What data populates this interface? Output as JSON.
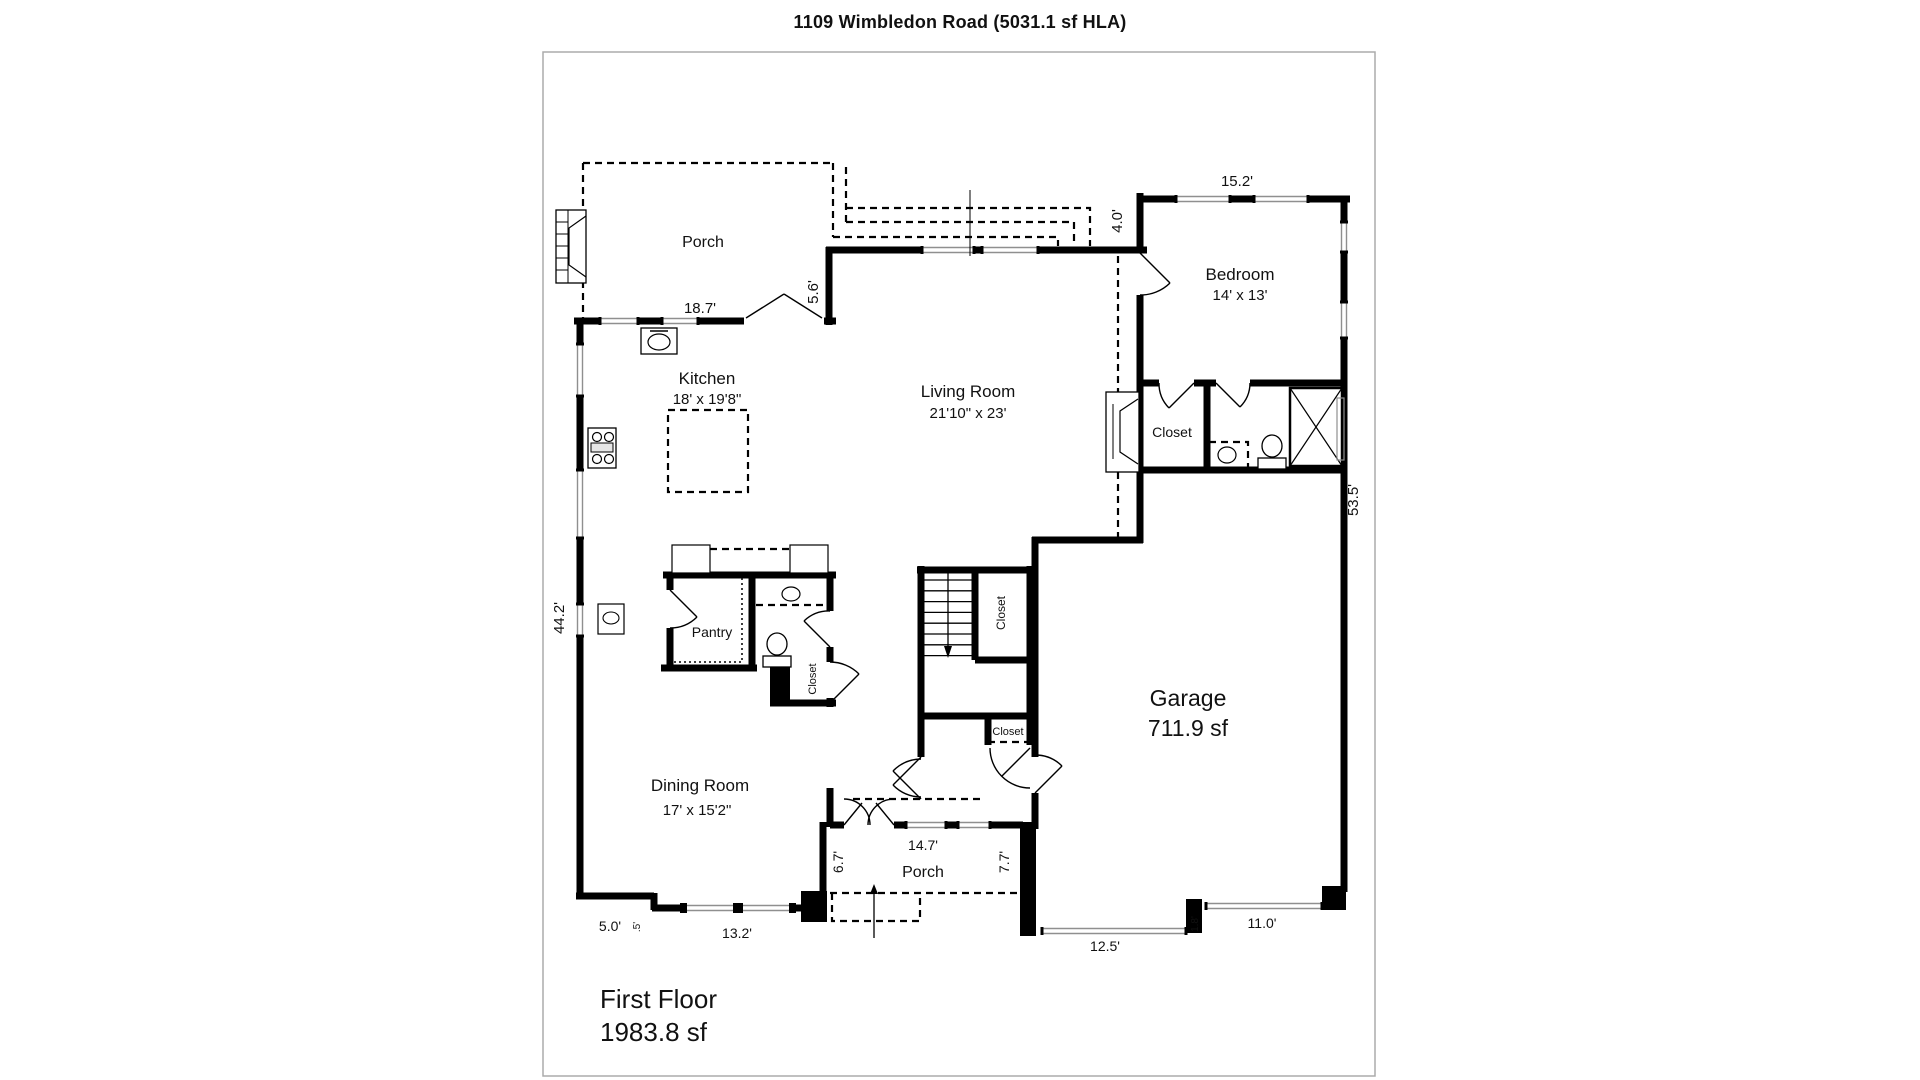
{
  "title": "1109 Wimbledon Road (5031.1 sf HLA)",
  "floor_summary": {
    "name": "First Floor",
    "area": "1983.8 sf"
  },
  "rooms": {
    "porch_top": {
      "label": "Porch"
    },
    "kitchen": {
      "label": "Kitchen",
      "dims": "18' x 19'8\""
    },
    "living_room": {
      "label": "Living Room",
      "dims": "21'10\" x 23'"
    },
    "bedroom": {
      "label": "Bedroom",
      "dims": "14' x 13'"
    },
    "bedroom_closet": {
      "label": "Closet"
    },
    "pantry": {
      "label": "Pantry"
    },
    "powder_closet": {
      "label": "Closet"
    },
    "stairs_closet": {
      "label": "Closet"
    },
    "hall_closet": {
      "label": "Closet"
    },
    "garage": {
      "label": "Garage",
      "area": "711.9 sf"
    },
    "dining_room": {
      "label": "Dining Room",
      "dims": "17' x 15'2\""
    },
    "porch_bottom": {
      "label": "Porch"
    }
  },
  "dimensions": {
    "kitchen_top_width": "18.7'",
    "kitchen_living_jog": "5.6'",
    "bedroom_top_width": "15.2'",
    "bedroom_living_jog": "4.0'",
    "right_side_depth": "53.5'",
    "left_side_depth": "44.2'",
    "front_porch_left": "6.7'",
    "front_porch_width": "14.7'",
    "front_porch_right": "7.7'",
    "bottom_left_width": "5.0'",
    "bottom_left_jog": ".5'",
    "dining_bay_width": "13.2'",
    "garage_door_left_width": "12.5'",
    "garage_front_jog": "1.8'",
    "garage_door_right_width": "11.0'"
  },
  "colors": {
    "wall": "#000000",
    "window_line": "#8f8f8f",
    "frame_border": "#ababab",
    "background": "#ffffff",
    "text": "#111111"
  }
}
